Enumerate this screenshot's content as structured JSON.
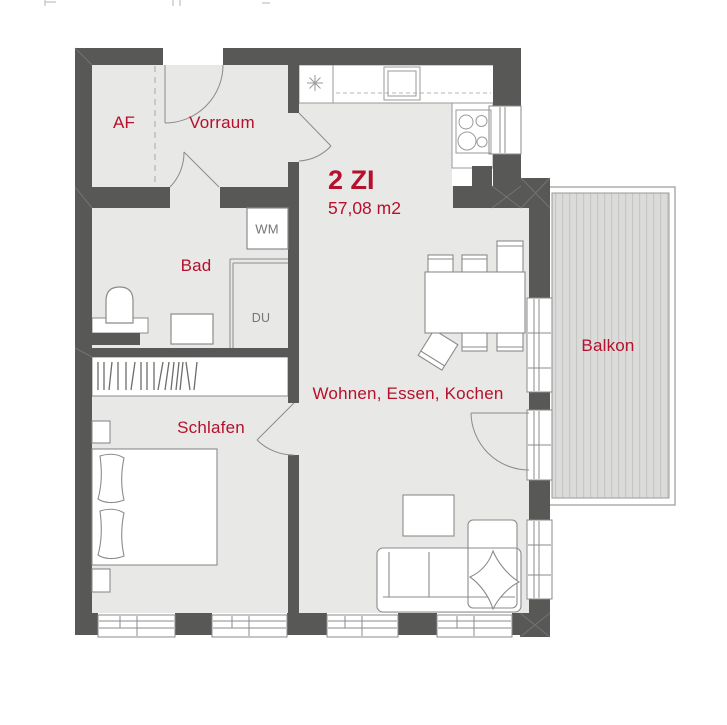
{
  "plan": {
    "unit_title": "2 ZI",
    "unit_area": "57,08 m2",
    "rooms": {
      "af": "AF",
      "vorraum": "Vorraum",
      "bad": "Bad",
      "schlafen": "Schlafen",
      "wohnen": "Wohnen, Essen, Kochen",
      "balkon": "Balkon"
    },
    "fixtures": {
      "washing_machine": "WM",
      "shower": "DU"
    },
    "colors": {
      "wall": "#585856",
      "room_fill": "#e8e8e7",
      "accent_red": "#b5102c",
      "label_gray": "#757573",
      "deck_fill": "#dbdbda",
      "deck_stripe": "#c7c7c6",
      "outline_gray": "#8b8b8d"
    }
  }
}
